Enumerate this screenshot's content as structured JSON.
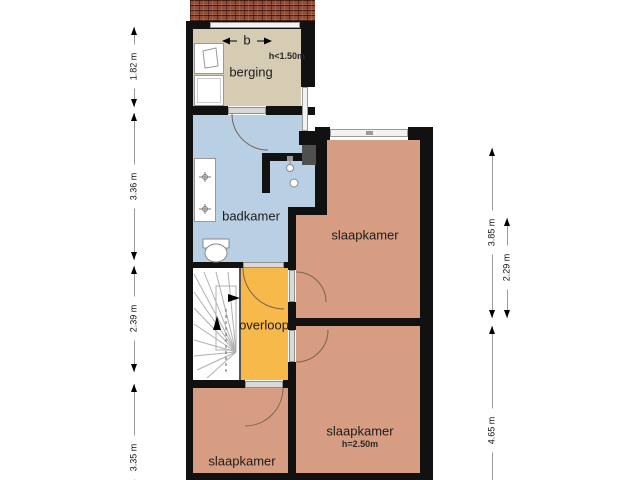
{
  "title": "floor-plan-first-floor",
  "colors": {
    "wall": "#111111",
    "berging": "#d6ccb3",
    "badkamer": "#b9cfe4",
    "slaapkamer": "#d79d82",
    "overloop": "#f7b94a",
    "roof_tile": "#8f4c38",
    "dimension_line": "#999999"
  },
  "rooms": {
    "berging": {
      "label": "berging",
      "marker": "b",
      "height_note": "h<1.50m"
    },
    "badkamer": {
      "label": "badkamer"
    },
    "slaapkamer_top": {
      "label": "slaapkamer"
    },
    "overloop": {
      "label": "overloop"
    },
    "slaapkamer_bottom_right": {
      "label": "slaapkamer",
      "height_note": "h=2.50m"
    },
    "slaapkamer_bottom_left": {
      "label": "slaapkamer"
    }
  },
  "dimensions": {
    "left": [
      {
        "label": "1.82 m"
      },
      {
        "label": "3.36 m"
      },
      {
        "label": "2.39 m"
      },
      {
        "label": "3.35 m"
      }
    ],
    "right": [
      {
        "label": "3.85 m"
      },
      {
        "label": "2.29 m"
      },
      {
        "label": "4.65 m"
      }
    ]
  }
}
